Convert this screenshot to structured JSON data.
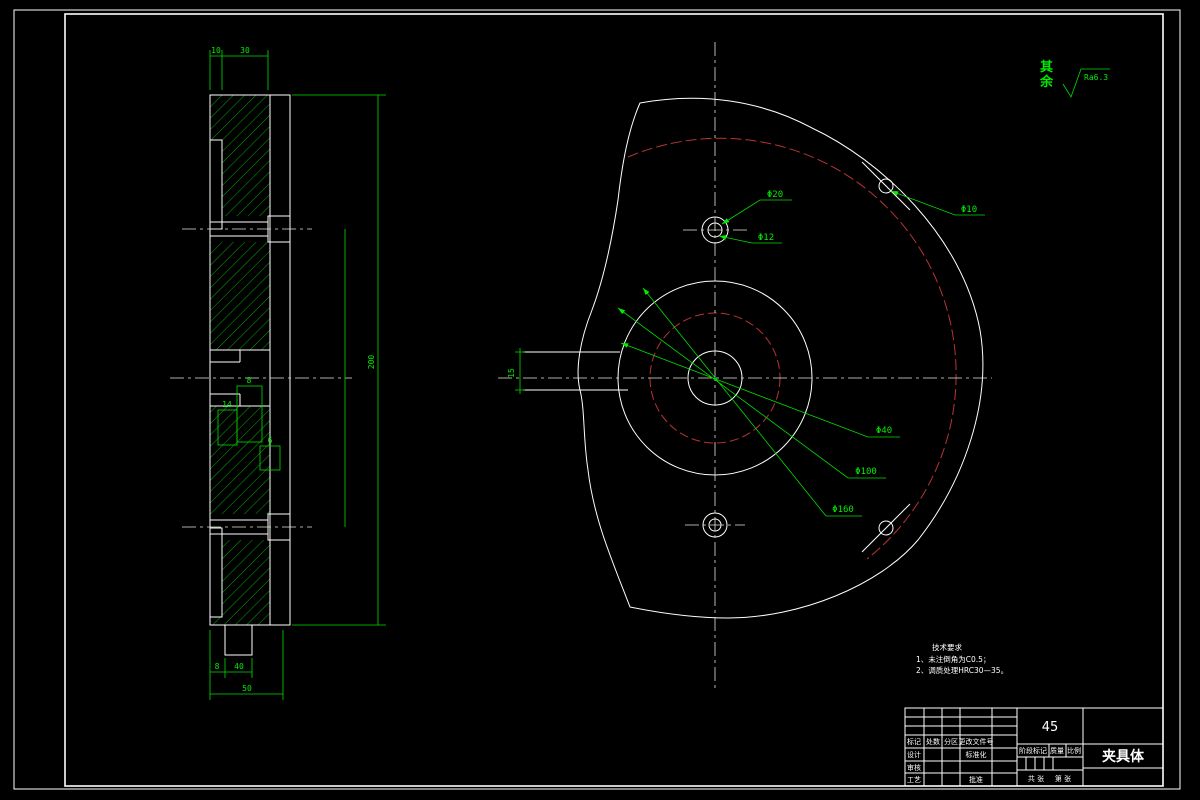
{
  "colors": {
    "background": "#000000",
    "outline": "#ffffff",
    "dimension": "#00ee00",
    "feature_red": "#b93434"
  },
  "roughness": {
    "label": "其余",
    "value": "Ra6.3"
  },
  "front_labels": {
    "hole_counterbore": "Φ20",
    "hole_through": "Φ12",
    "hole_small": "Φ10",
    "bore": "Φ40",
    "circle_mid": "Φ100",
    "circle_outer": "Φ160",
    "slot_width": "15"
  },
  "side_dims": {
    "top_small": "10",
    "top_large": "30",
    "overall_height": "200",
    "groove_a": "8",
    "groove_b": "14",
    "groove_c": "6",
    "bottom_small": "8",
    "bottom_mid": "40",
    "bottom_overall": "50"
  },
  "notes": {
    "header": "技术要求",
    "line1": "1、未注倒角为C0.5；",
    "line2": "2、调质处理HRC30—35。"
  },
  "title_block": {
    "material": "45",
    "part_name": "夹具体",
    "mark": "标记",
    "count": "处数",
    "zone": "分区",
    "change_doc": "更改文件号",
    "design": "设计",
    "standardize": "标准化",
    "check": "审核",
    "process": "工艺",
    "approve": "批准",
    "stage": "阶段标记",
    "mass": "质量",
    "scale": "比例",
    "sheets": "共 张",
    "page": "第 张"
  }
}
